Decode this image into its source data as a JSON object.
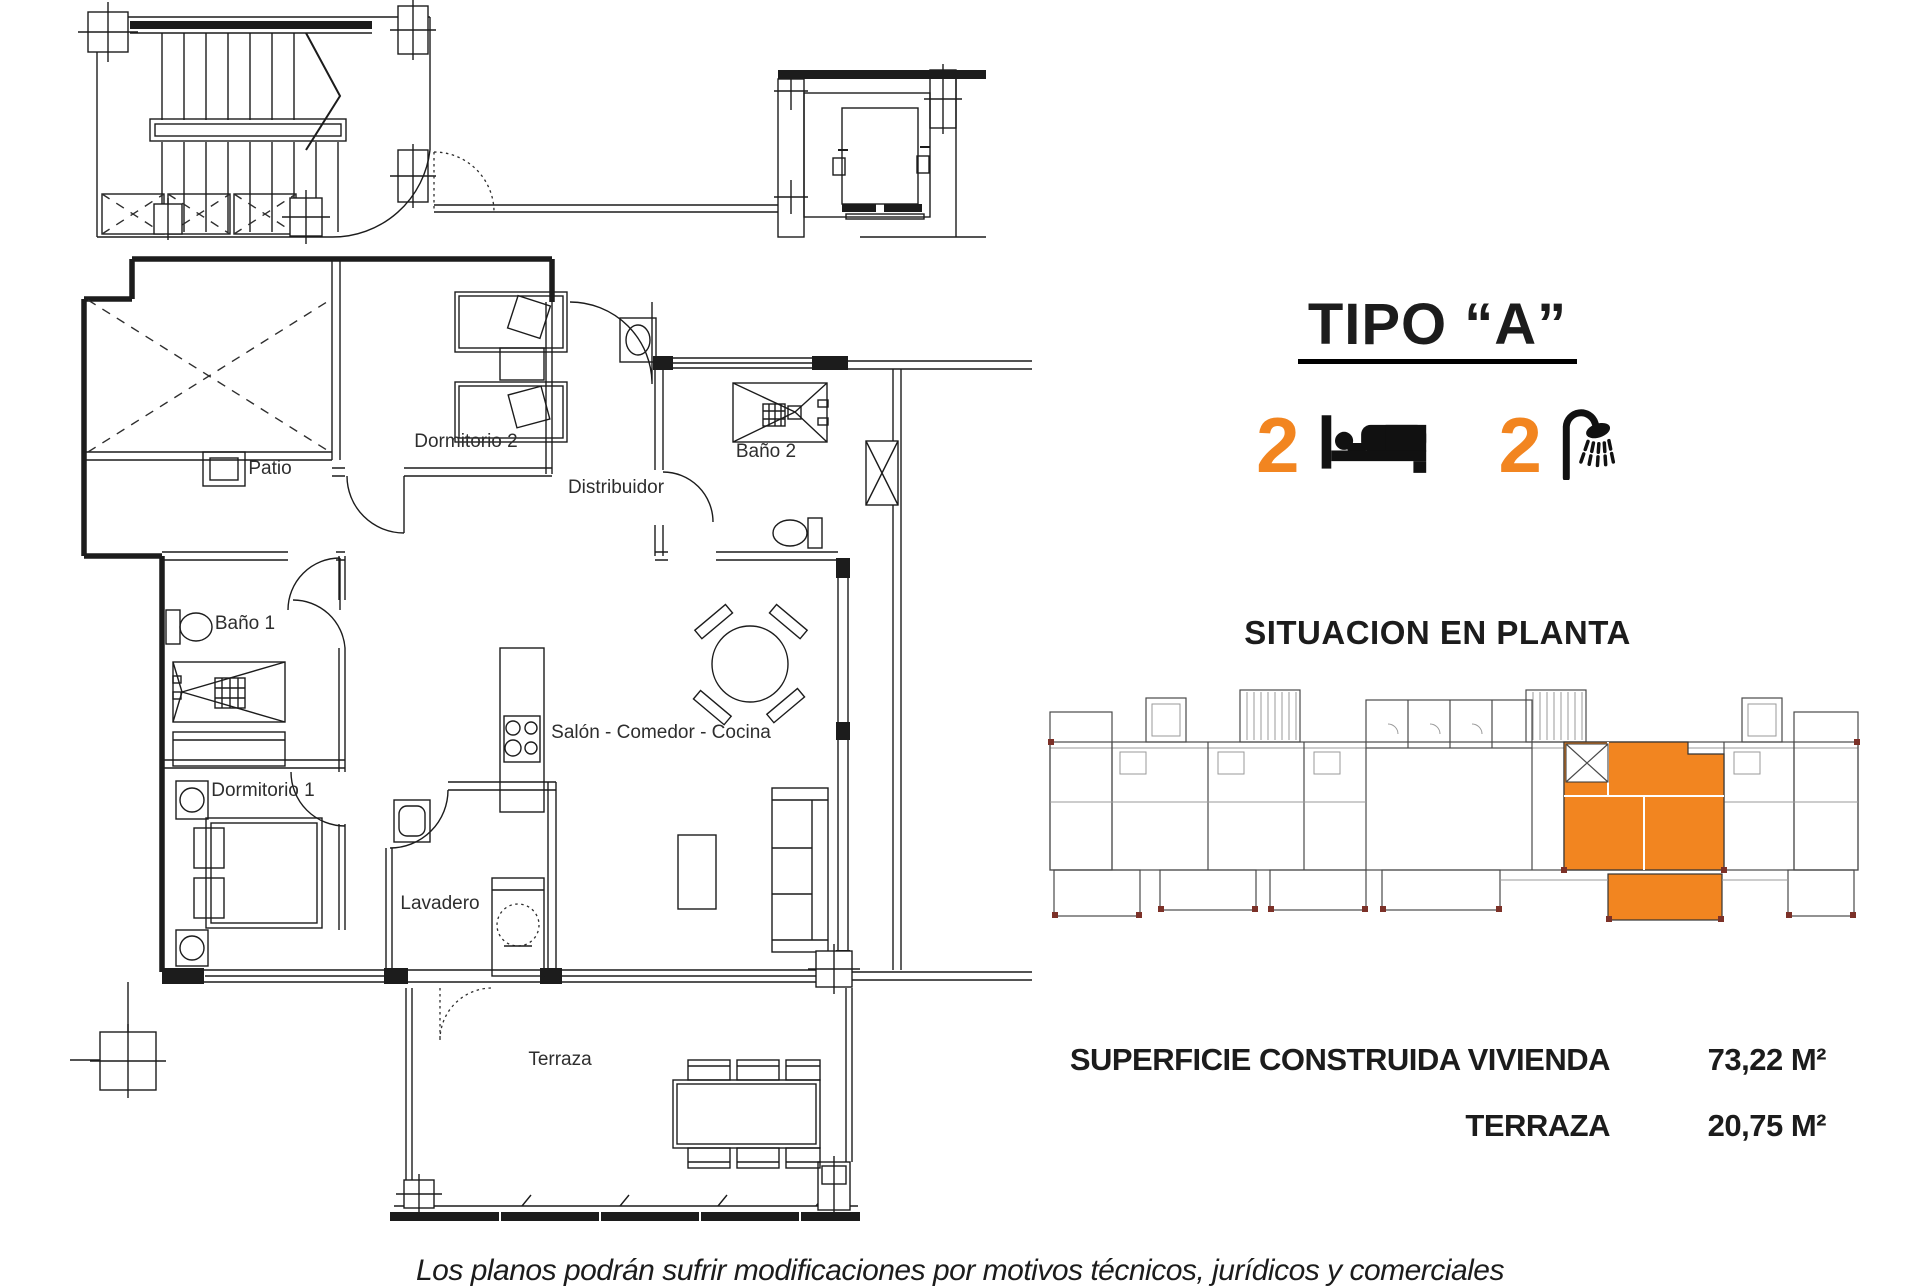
{
  "colors": {
    "accent_orange": "#F28520",
    "plan_ink": "#1c1c1c",
    "column_mark_brown": "#7c3128"
  },
  "header": {
    "title": "TIPO “A”"
  },
  "features": {
    "bedrooms": {
      "count": "2",
      "icon": "bed-icon"
    },
    "bathrooms": {
      "count": "2",
      "icon": "shower-icon"
    }
  },
  "situacion": {
    "heading": "SITUACION EN PLANTA"
  },
  "plan": {
    "rooms": {
      "patio": "Patio",
      "dormitorio2": "Dormitorio 2",
      "bano2": "Baño 2",
      "distribuidor": "Distribuidor",
      "bano1": "Baño 1",
      "dormitorio1": "Dormitorio 1",
      "salon": "Salón - Comedor - Cocina",
      "lavadero": "Lavadero",
      "terraza": "Terraza"
    }
  },
  "surfaces": {
    "rows": [
      {
        "label": "SUPERFICIE CONSTRUIDA VIVIENDA",
        "value": "73,22 M²"
      },
      {
        "label": "TERRAZA",
        "value": "20,75 M²"
      }
    ]
  },
  "disclaimer": "Los planos podrán sufrir modificaciones por motivos técnicos, jurídicos y comerciales"
}
